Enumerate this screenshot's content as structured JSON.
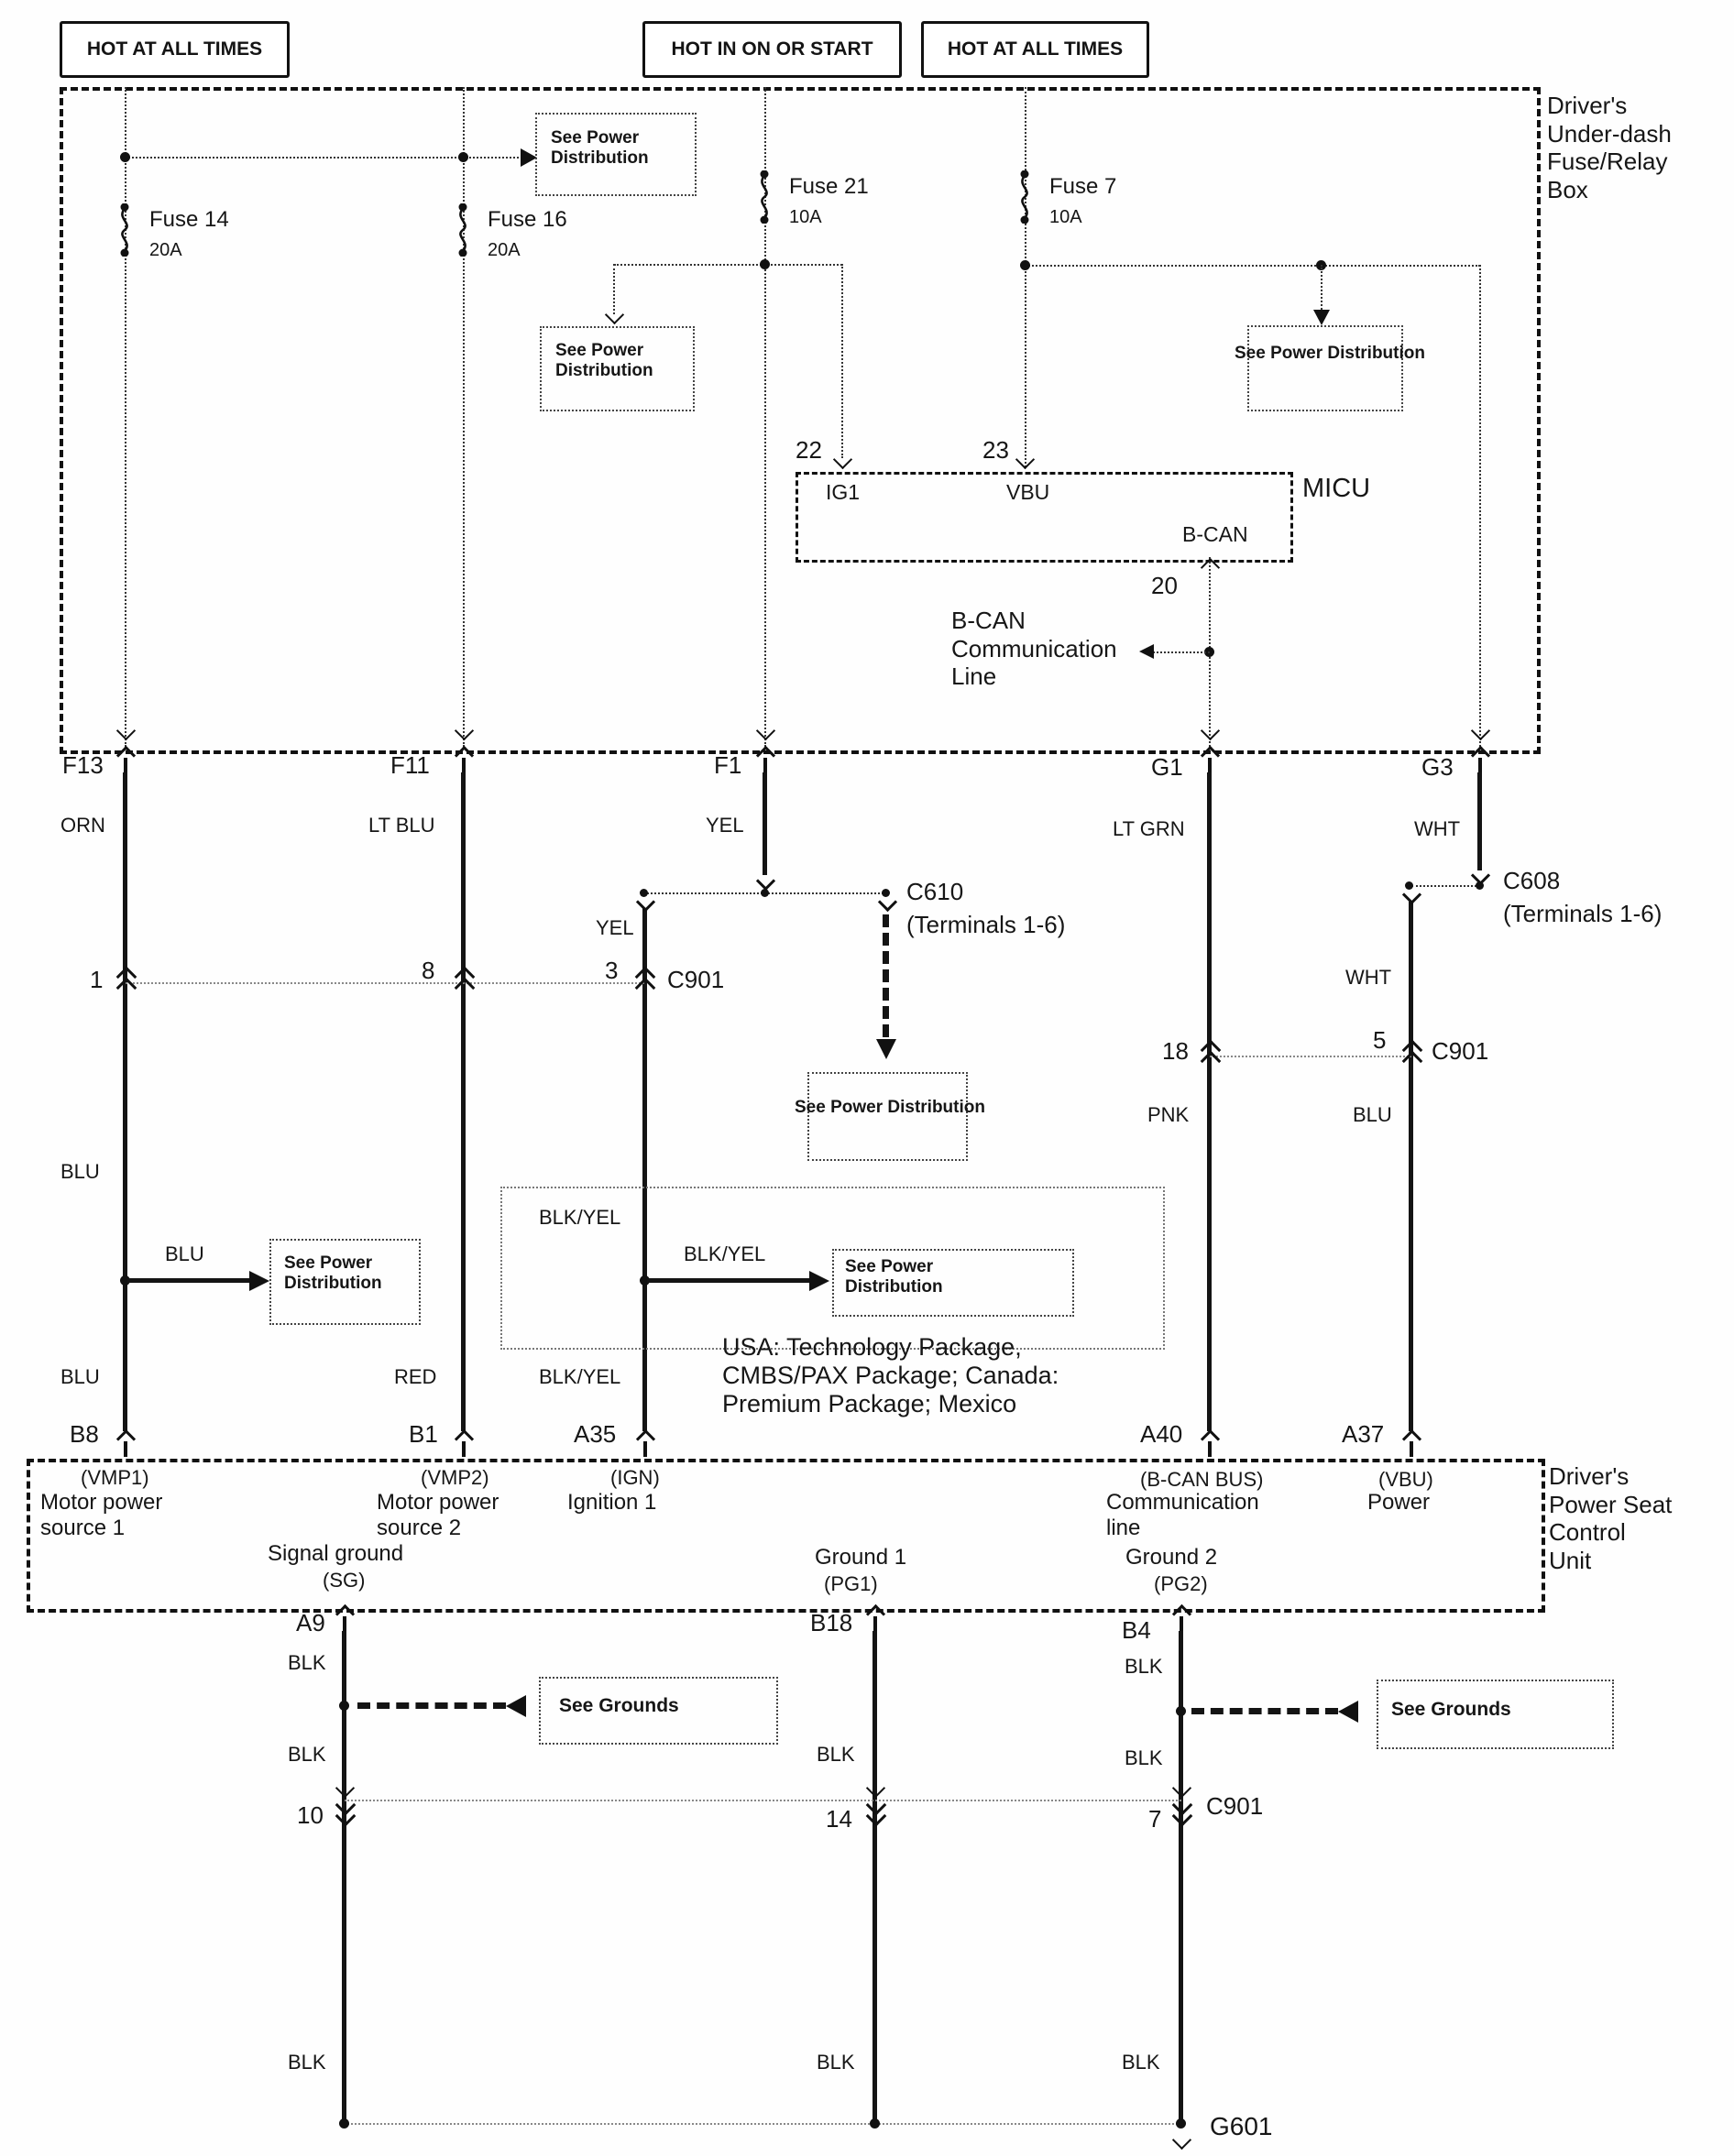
{
  "headers": {
    "h1": "HOT AT ALL TIMES",
    "h2": "HOT IN ON OR START",
    "h3": "HOT AT ALL TIMES"
  },
  "fuse_box": {
    "title": [
      "Driver's",
      "Under-dash",
      "Fuse/Relay",
      "Box"
    ],
    "fuses": [
      {
        "name": "Fuse 14",
        "rating": "20A"
      },
      {
        "name": "Fuse 16",
        "rating": "20A"
      },
      {
        "name": "Fuse 21",
        "rating": "10A"
      },
      {
        "name": "Fuse 7",
        "rating": "10A"
      }
    ],
    "connectors": {
      "f13": "F13",
      "f11": "F11",
      "f1": "F1",
      "g1": "G1",
      "g3": "G3"
    }
  },
  "micu": {
    "name": "MICU",
    "pin_22": "22",
    "pin_23": "23",
    "pin_20": "20",
    "ig1": "IG1",
    "vbu": "VBU",
    "b_can": "B-CAN",
    "comm_line": [
      "B-CAN",
      "Communication",
      "Line"
    ]
  },
  "refs": {
    "see_power_2line": [
      "See Power",
      "Distribution"
    ],
    "see_power_1line": "See Power Distribution",
    "see_grounds": "See Grounds"
  },
  "wire_colors": {
    "orn": "ORN",
    "lt_blu": "LT BLU",
    "yel": "YEL",
    "lt_grn": "LT GRN",
    "wht": "WHT",
    "blu": "BLU",
    "red": "RED",
    "blk_yel": "BLK/YEL",
    "pnk": "PNK",
    "blk": "BLK"
  },
  "inline_connectors": {
    "c901": "C901",
    "c610": "C610",
    "c608": "C608",
    "terminals": "(Terminals 1-6)",
    "g601": "G601",
    "pins": {
      "p1": "1",
      "p8": "8",
      "p3": "3",
      "p18": "18",
      "p5": "5",
      "p10": "10",
      "p14": "14",
      "p7": "7"
    }
  },
  "note": [
    "USA: Technology Package,",
    "CMBS/PAX Package; Canada:",
    "Premium Package; Mexico"
  ],
  "control_unit": {
    "title": [
      "Driver's",
      "Power Seat",
      "Control",
      "Unit"
    ],
    "pins_top": {
      "b8": "B8",
      "b1": "B1",
      "a35": "A35",
      "a40": "A40",
      "a37": "A37"
    },
    "pins_bottom": {
      "a9": "A9",
      "b18": "B18",
      "b4": "B4"
    },
    "vmp1": [
      "(VMP1)",
      "Motor power",
      "source 1"
    ],
    "vmp2": [
      "(VMP2)",
      "Motor power",
      "source 2"
    ],
    "ign": [
      "(IGN)",
      "Ignition 1"
    ],
    "bcan": [
      "(B-CAN BUS)",
      "Communication",
      "line"
    ],
    "vbu": [
      "(VBU)",
      "Power"
    ],
    "sg": [
      "Signal ground",
      "(SG)"
    ],
    "pg1": [
      "Ground 1",
      "(PG1)"
    ],
    "pg2": [
      "Ground 2",
      "(PG2)"
    ]
  }
}
